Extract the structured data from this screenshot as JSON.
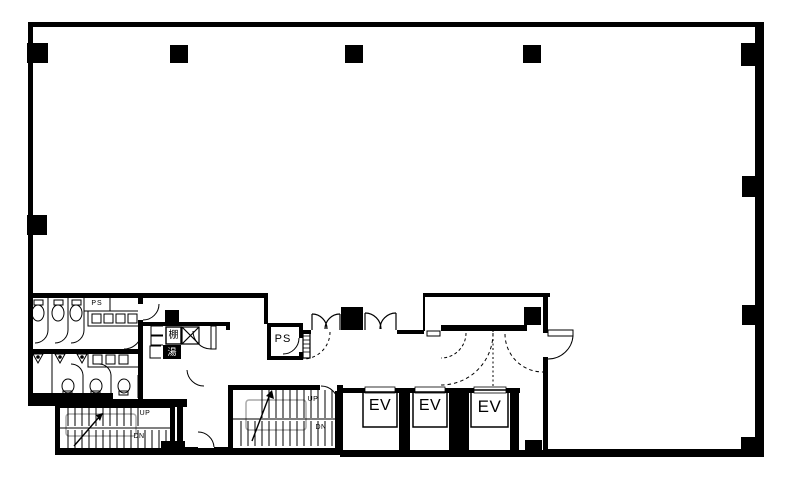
{
  "plan": {
    "background": "#ffffff",
    "ink": "#000000",
    "landing_outline": "#a9a9a9",
    "core": {
      "toilet_pipe_shaft": {
        "label": "PS"
      },
      "pipe_shaft_room": {
        "label": "PS"
      },
      "kitchenette": {
        "shelf_label": "棚",
        "sink_label": "湯"
      },
      "elevators": [
        {
          "label": "EV"
        },
        {
          "label": "EV"
        },
        {
          "label": "EV"
        }
      ],
      "main_stair": {
        "up_label": "UP",
        "down_label": "DN"
      },
      "escape_stair": {
        "up_label": "UP",
        "down_label": "DN"
      }
    }
  }
}
